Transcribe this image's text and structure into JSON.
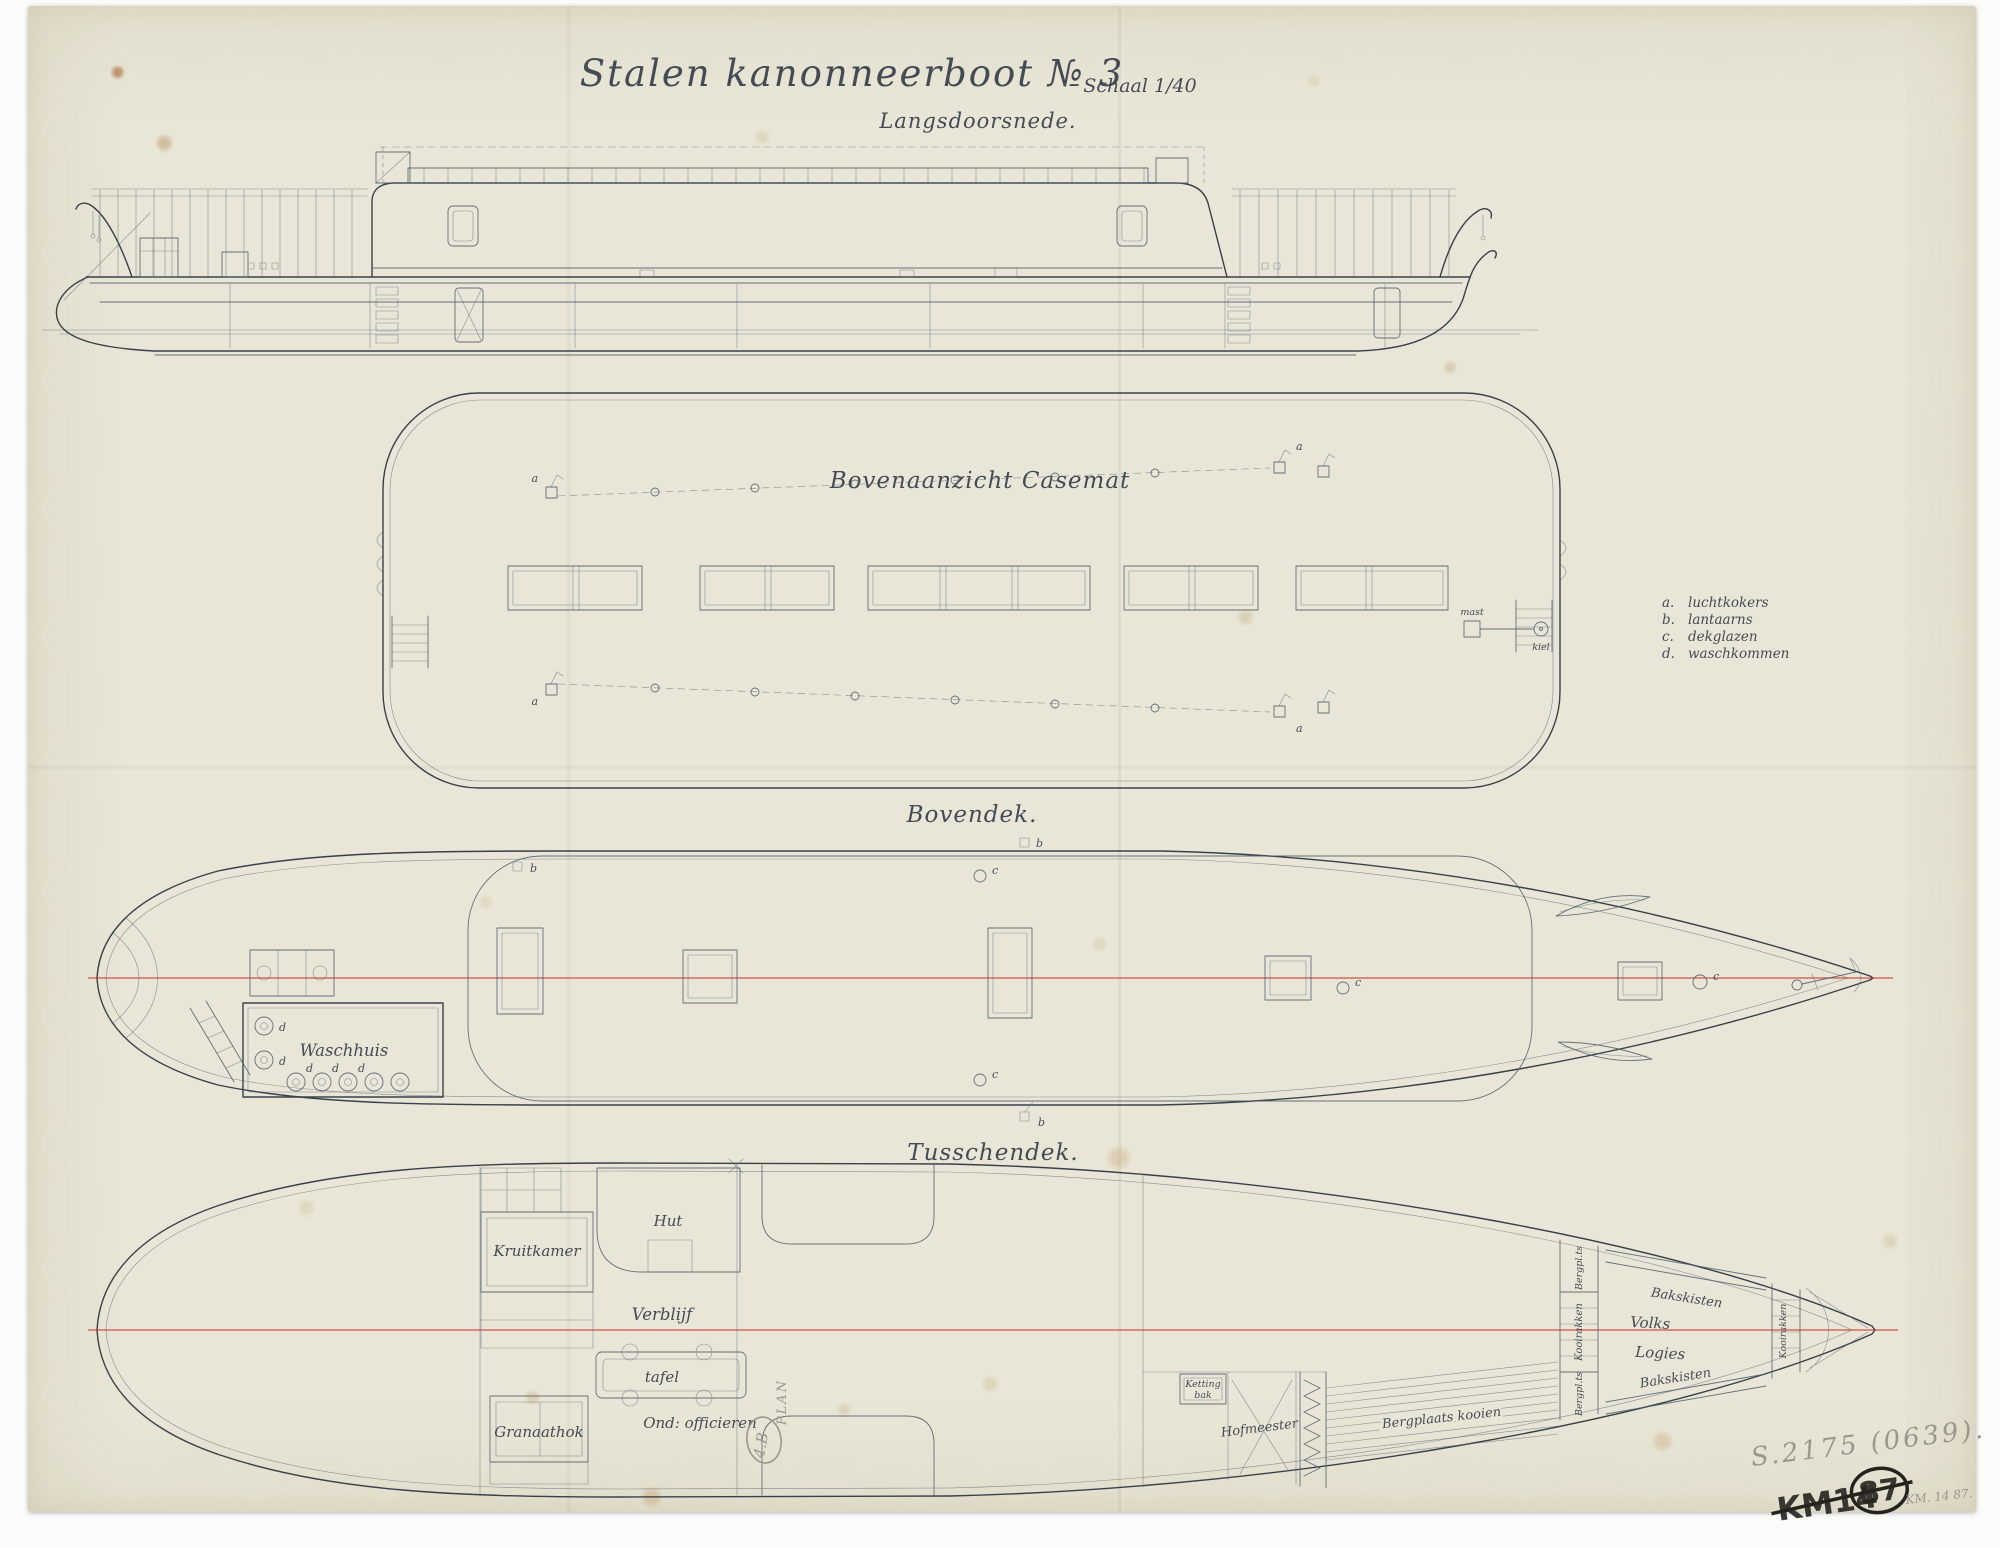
{
  "drawing": {
    "title": "Stalen kanonneerboot № 3",
    "scale": "Schaal 1/40",
    "subtitle": "Langsdoorsnede."
  },
  "view_labels": {
    "casemate_top": "Bovenaanzicht Casemat",
    "upper_deck": "Bovendek.",
    "tween_deck": "Tusschendek."
  },
  "legend": {
    "items": [
      {
        "key": "a.",
        "label": "luchtkokers"
      },
      {
        "key": "b.",
        "label": "lantaarns"
      },
      {
        "key": "c.",
        "label": "dekglazen"
      },
      {
        "key": "d.",
        "label": "waschkommen"
      }
    ]
  },
  "markers": {
    "a": "a",
    "b": "b",
    "c": "c",
    "d": "d",
    "mast": "mast",
    "kiel": "kiel"
  },
  "upper_deck": {
    "washhouse": "Waschhuis"
  },
  "tween_deck": {
    "kruitkamer": "Kruitkamer",
    "hut": "Hut",
    "verblijf": "Verblijf",
    "tafel": "tafel",
    "ond_officieren": "Ond: officieren",
    "granaathok": "Granaathok",
    "ketting": "Ketting",
    "bak": "bak",
    "hofmeester": "Hofmeester",
    "bergplaats_kooien": "Bergplaats kooien",
    "bakskisten": "Bakskisten",
    "volks": "Volks",
    "logies": "Logies",
    "bergplts": "Bergpl.ts",
    "kooirakken": "Kooirakken"
  },
  "annotations": {
    "plan_code": "4.B",
    "plan_word": "PLAN",
    "inventory_pencil": "S.2175 (0639).",
    "km_marker": "KM14",
    "km_number": "87",
    "km_pencil": "KM. 14 87."
  },
  "colors": {
    "paper": "#e9e6d7",
    "ink": "#39404a",
    "centerline_red": "#c23127",
    "pencil": "#9b978c",
    "marker_black": "#26231f"
  }
}
